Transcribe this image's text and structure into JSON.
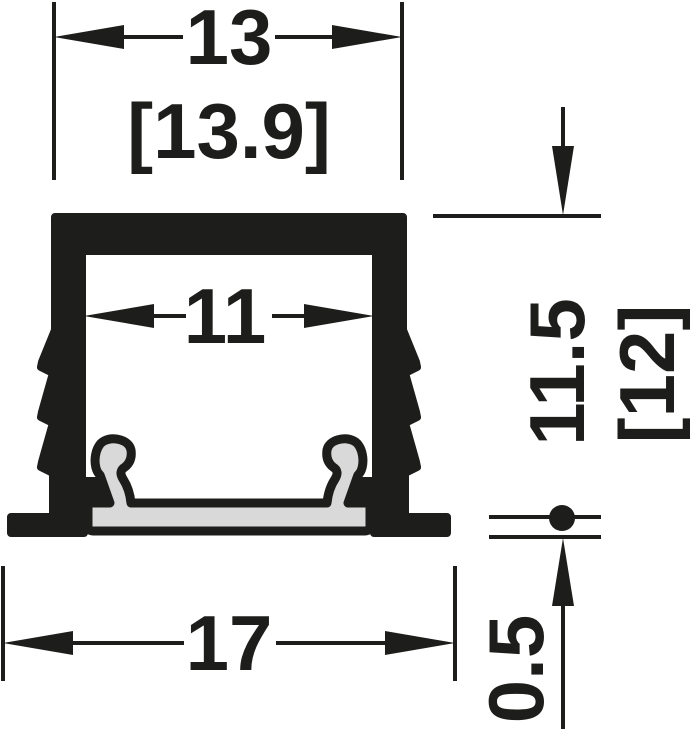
{
  "document": {
    "title": "Recessed aluminium LED profile cross-section drawing",
    "units": "mm"
  },
  "colors": {
    "line": "#1d1d1b",
    "diffuser_fill": "#d8d9d8",
    "background": "#ffffff"
  },
  "dimensions": {
    "top_width": {
      "label": "13",
      "alt_label": "[13.9]"
    },
    "inner_width": {
      "label": "11"
    },
    "height": {
      "label": "11.5",
      "alt_label": "[12]"
    },
    "bottom_width": {
      "label": "17"
    },
    "flange_thickness": {
      "label": "0.5"
    }
  }
}
